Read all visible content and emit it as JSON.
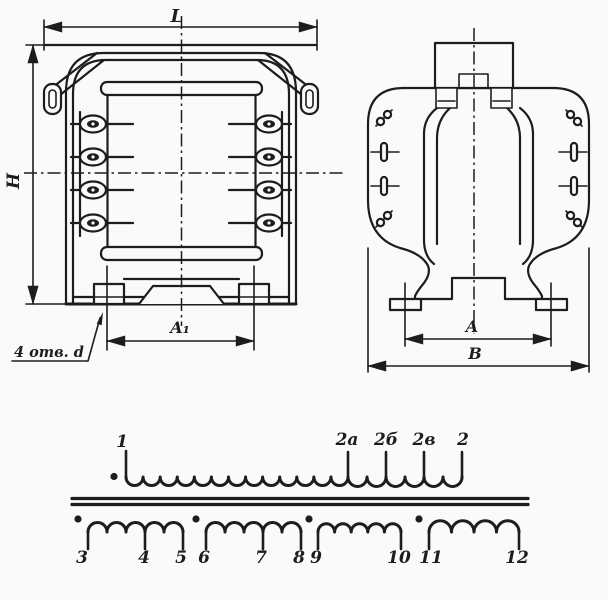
{
  "colors": {
    "ink": "#1d1d1d",
    "paper": "#fbfaf8"
  },
  "front_view": {
    "dim_width": "L",
    "dim_height": "H",
    "dim_mount_holes": "A₁",
    "holes_note": "4 отв. d"
  },
  "side_view": {
    "dim_mount_holes": "A",
    "dim_width": "B"
  },
  "schematic": {
    "primary": {
      "start": "1",
      "tap_a": "2а",
      "tap_b": "2б",
      "tap_c": "2в",
      "end": "2"
    },
    "secondary": [
      "3",
      "4",
      "5",
      "6",
      "7",
      "8",
      "9",
      "10",
      "11",
      "12"
    ]
  }
}
